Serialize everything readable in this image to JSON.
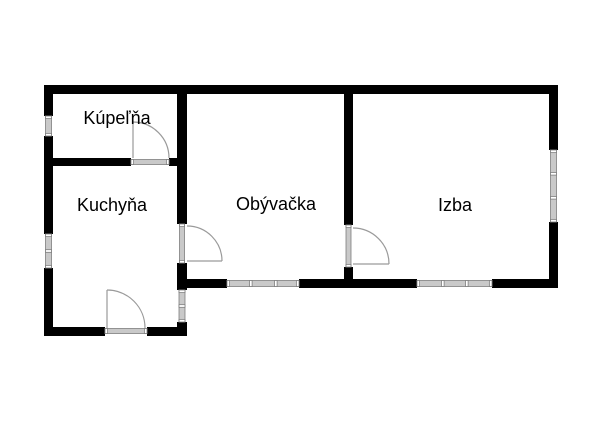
{
  "floor_plan": {
    "title": "floor-plan",
    "rooms": [
      {
        "name": "Kúpeľňa",
        "type": "bathroom"
      },
      {
        "name": "Kuchyňa",
        "type": "kitchen"
      },
      {
        "name": "Obývačka",
        "type": "living-room"
      },
      {
        "name": "Izba",
        "type": "room"
      }
    ],
    "door_count": 4,
    "window_count": 6,
    "colors": {
      "bg": "#ffffff",
      "wall": "#000000",
      "window_fill": "#c9c9c9",
      "window_stroke": "#7e7e7e",
      "door": "#9a9a9a",
      "label": "#000000"
    }
  }
}
